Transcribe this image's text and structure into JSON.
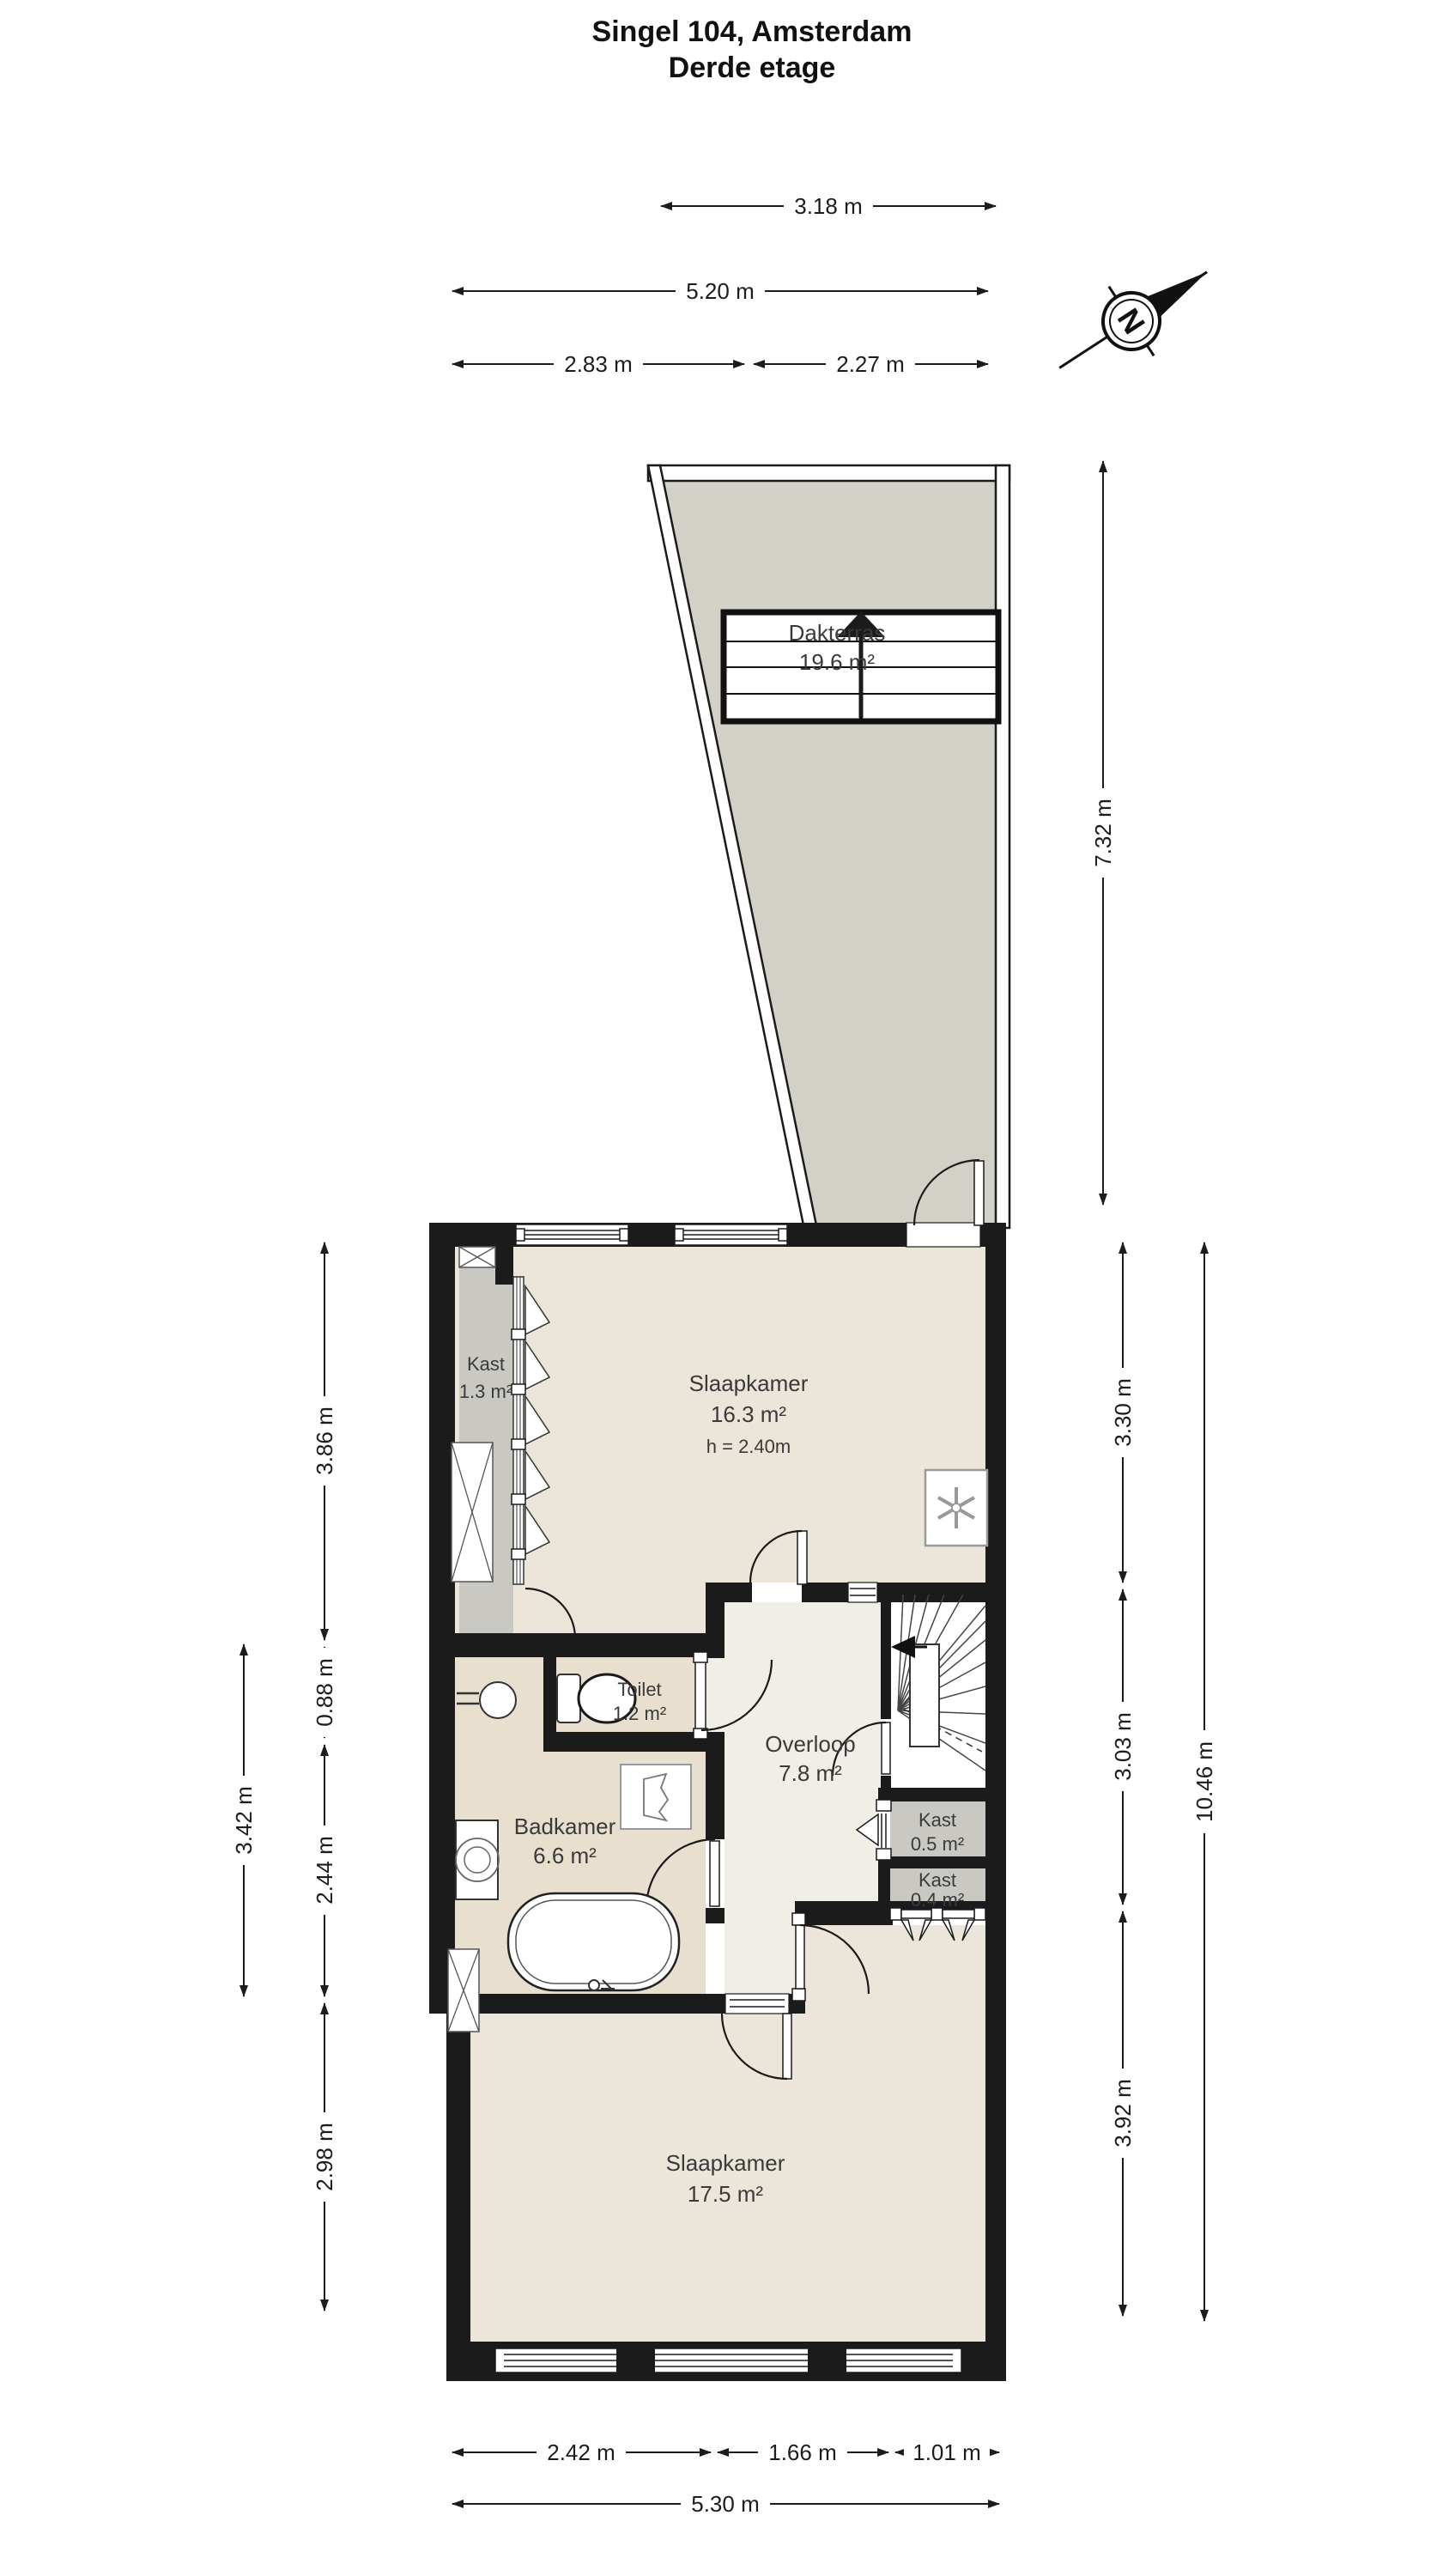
{
  "title": {
    "line1": "Singel 104, Amsterdam",
    "line2": "Derde etage"
  },
  "compass": {
    "label": "N"
  },
  "rooms": {
    "dakterras": {
      "name": "Dakterras",
      "area": "19.6 m²"
    },
    "kast_boven": {
      "name": "Kast",
      "area": "1.3 m²"
    },
    "slaapkamer1": {
      "name": "Slaapkamer",
      "area": "16.3 m²",
      "ceiling": "h = 2.40m"
    },
    "toilet": {
      "name": "Toilet",
      "area": "1.2 m²"
    },
    "overloop": {
      "name": "Overloop",
      "area": "7.8 m²"
    },
    "badkamer": {
      "name": "Badkamer",
      "area": "6.6 m²"
    },
    "kast_05": {
      "name": "Kast",
      "area": "0.5 m²"
    },
    "kast_04": {
      "name": "Kast",
      "area": "0.4 m²"
    },
    "slaapkamer2": {
      "name": "Slaapkamer",
      "area": "17.5 m²"
    }
  },
  "dimensions": {
    "top": {
      "d318": "3.18 m",
      "d520": "5.20 m",
      "d283": "2.83 m",
      "d227": "2.27 m"
    },
    "left": {
      "d386": "3.86 m",
      "d088": "0.88 m",
      "d244": "2.44 m",
      "d298": "2.98 m",
      "d342": "3.42 m"
    },
    "right": {
      "d732": "7.32 m",
      "d330": "3.30 m",
      "d303": "3.03 m",
      "d392": "3.92 m",
      "d1046": "10.46 m"
    },
    "bottom": {
      "d242": "2.42 m",
      "d166": "1.66 m",
      "d101": "1.01 m",
      "d530": "5.30 m"
    }
  },
  "colors": {
    "wall": "#1b1b1b",
    "floor_bedroom": "#ebe6d9",
    "floor_hall": "#f0eee7",
    "floor_bathroom": "#e8dfcf",
    "floor_terrace": "#d3d0c8",
    "floor_closet": "#c9c8c2",
    "dimension_line": "#1c1c1c",
    "label_text": "#3a3a3a"
  }
}
